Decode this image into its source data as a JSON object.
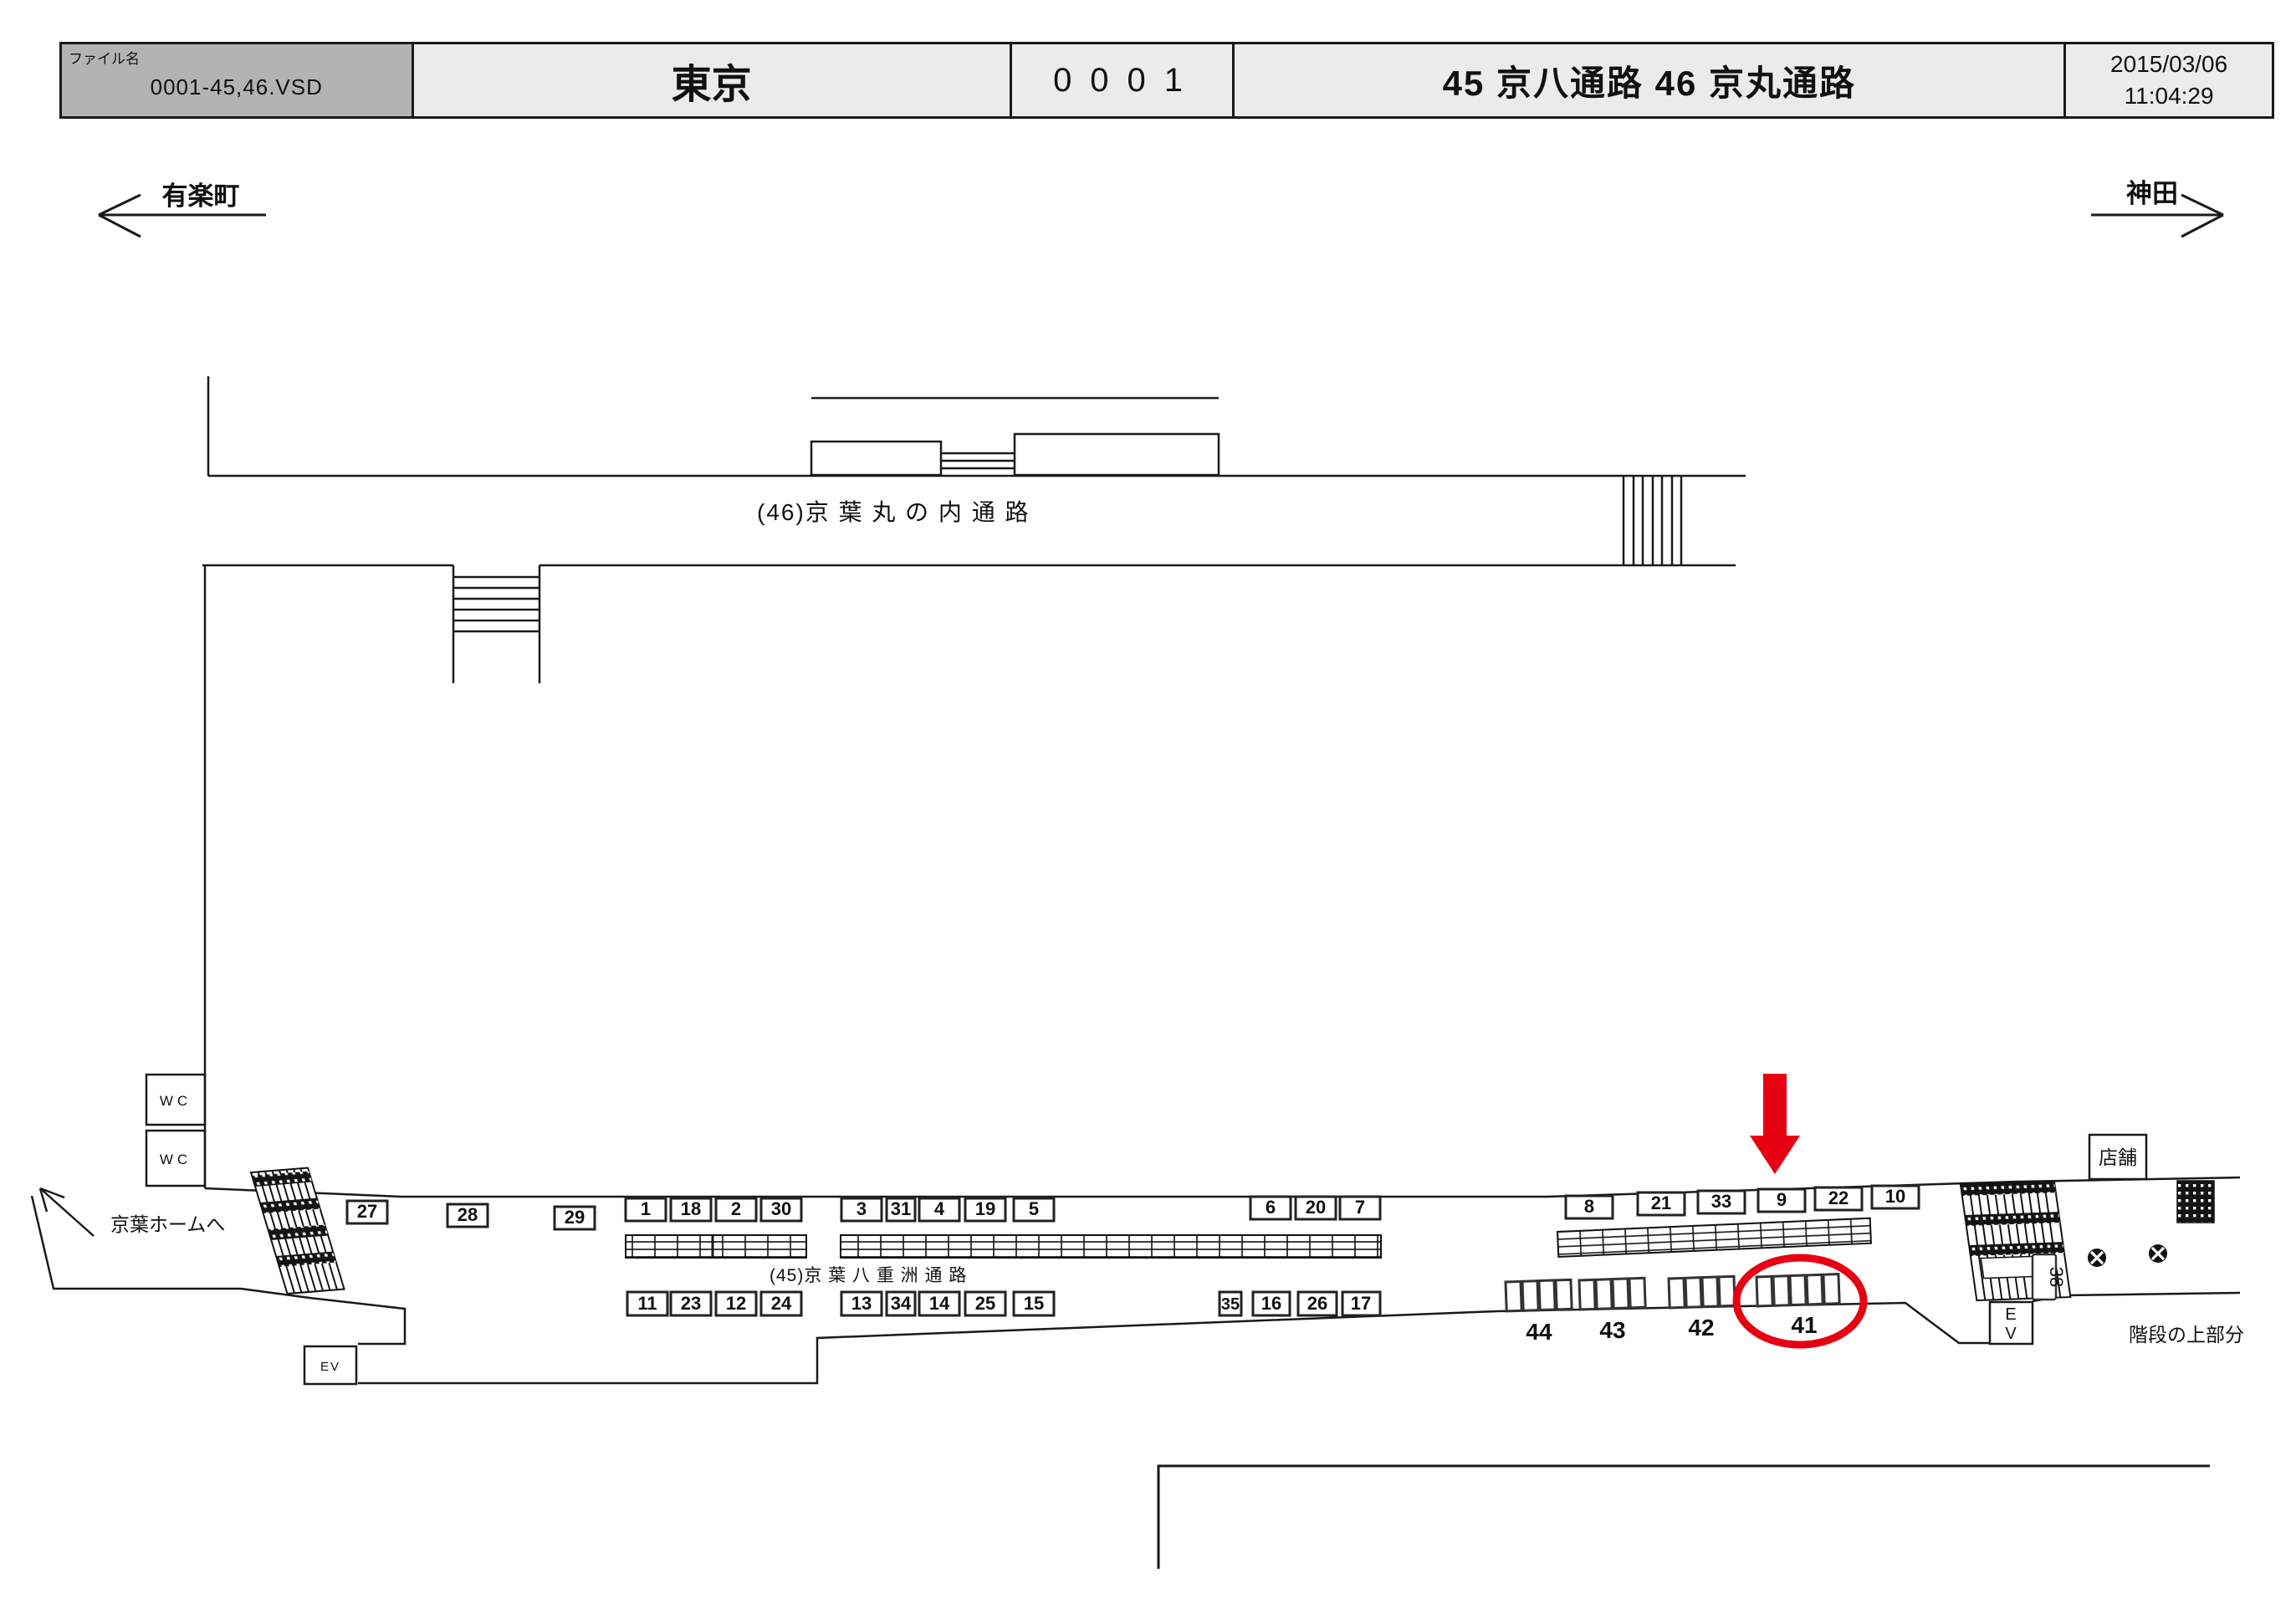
{
  "header": {
    "file_label": "ファイル名",
    "file_name": "0001-45,46.VSD",
    "station": "東京",
    "sheet_number": "0001",
    "route_title": "45 京八通路  46 京丸通路",
    "date": "2015/03/06",
    "time": "11:04:29"
  },
  "directions": {
    "left": "有楽町",
    "right": "神田"
  },
  "corridors": {
    "upper_label": "(46)京 葉 丸 の 内 通 路",
    "lower_label": "(45)京 葉 八 重 洲 通 路"
  },
  "plan": {
    "top_row": [
      "27",
      "28",
      "29",
      "1",
      "18",
      "2",
      "30",
      "3",
      "31",
      "4",
      "19",
      "5",
      "6",
      "20",
      "7",
      "8",
      "21",
      "33",
      "9",
      "22",
      "10"
    ],
    "bottom_row": [
      "11",
      "23",
      "12",
      "24",
      "13",
      "34",
      "14",
      "25",
      "15",
      "35",
      "16",
      "26",
      "17"
    ],
    "floor_groups": [
      "44",
      "43",
      "42",
      "41"
    ],
    "labels": {
      "wc1": "WC",
      "wc2": "WC",
      "ev_left": "EV",
      "ev_right": [
        "E",
        "V"
      ],
      "stair_tag": "38",
      "shop": "店舗",
      "stair_top": "階段の上部分",
      "keiyo_home": "京葉ホームへ"
    },
    "colors": {
      "highlight": "#e60012"
    }
  }
}
